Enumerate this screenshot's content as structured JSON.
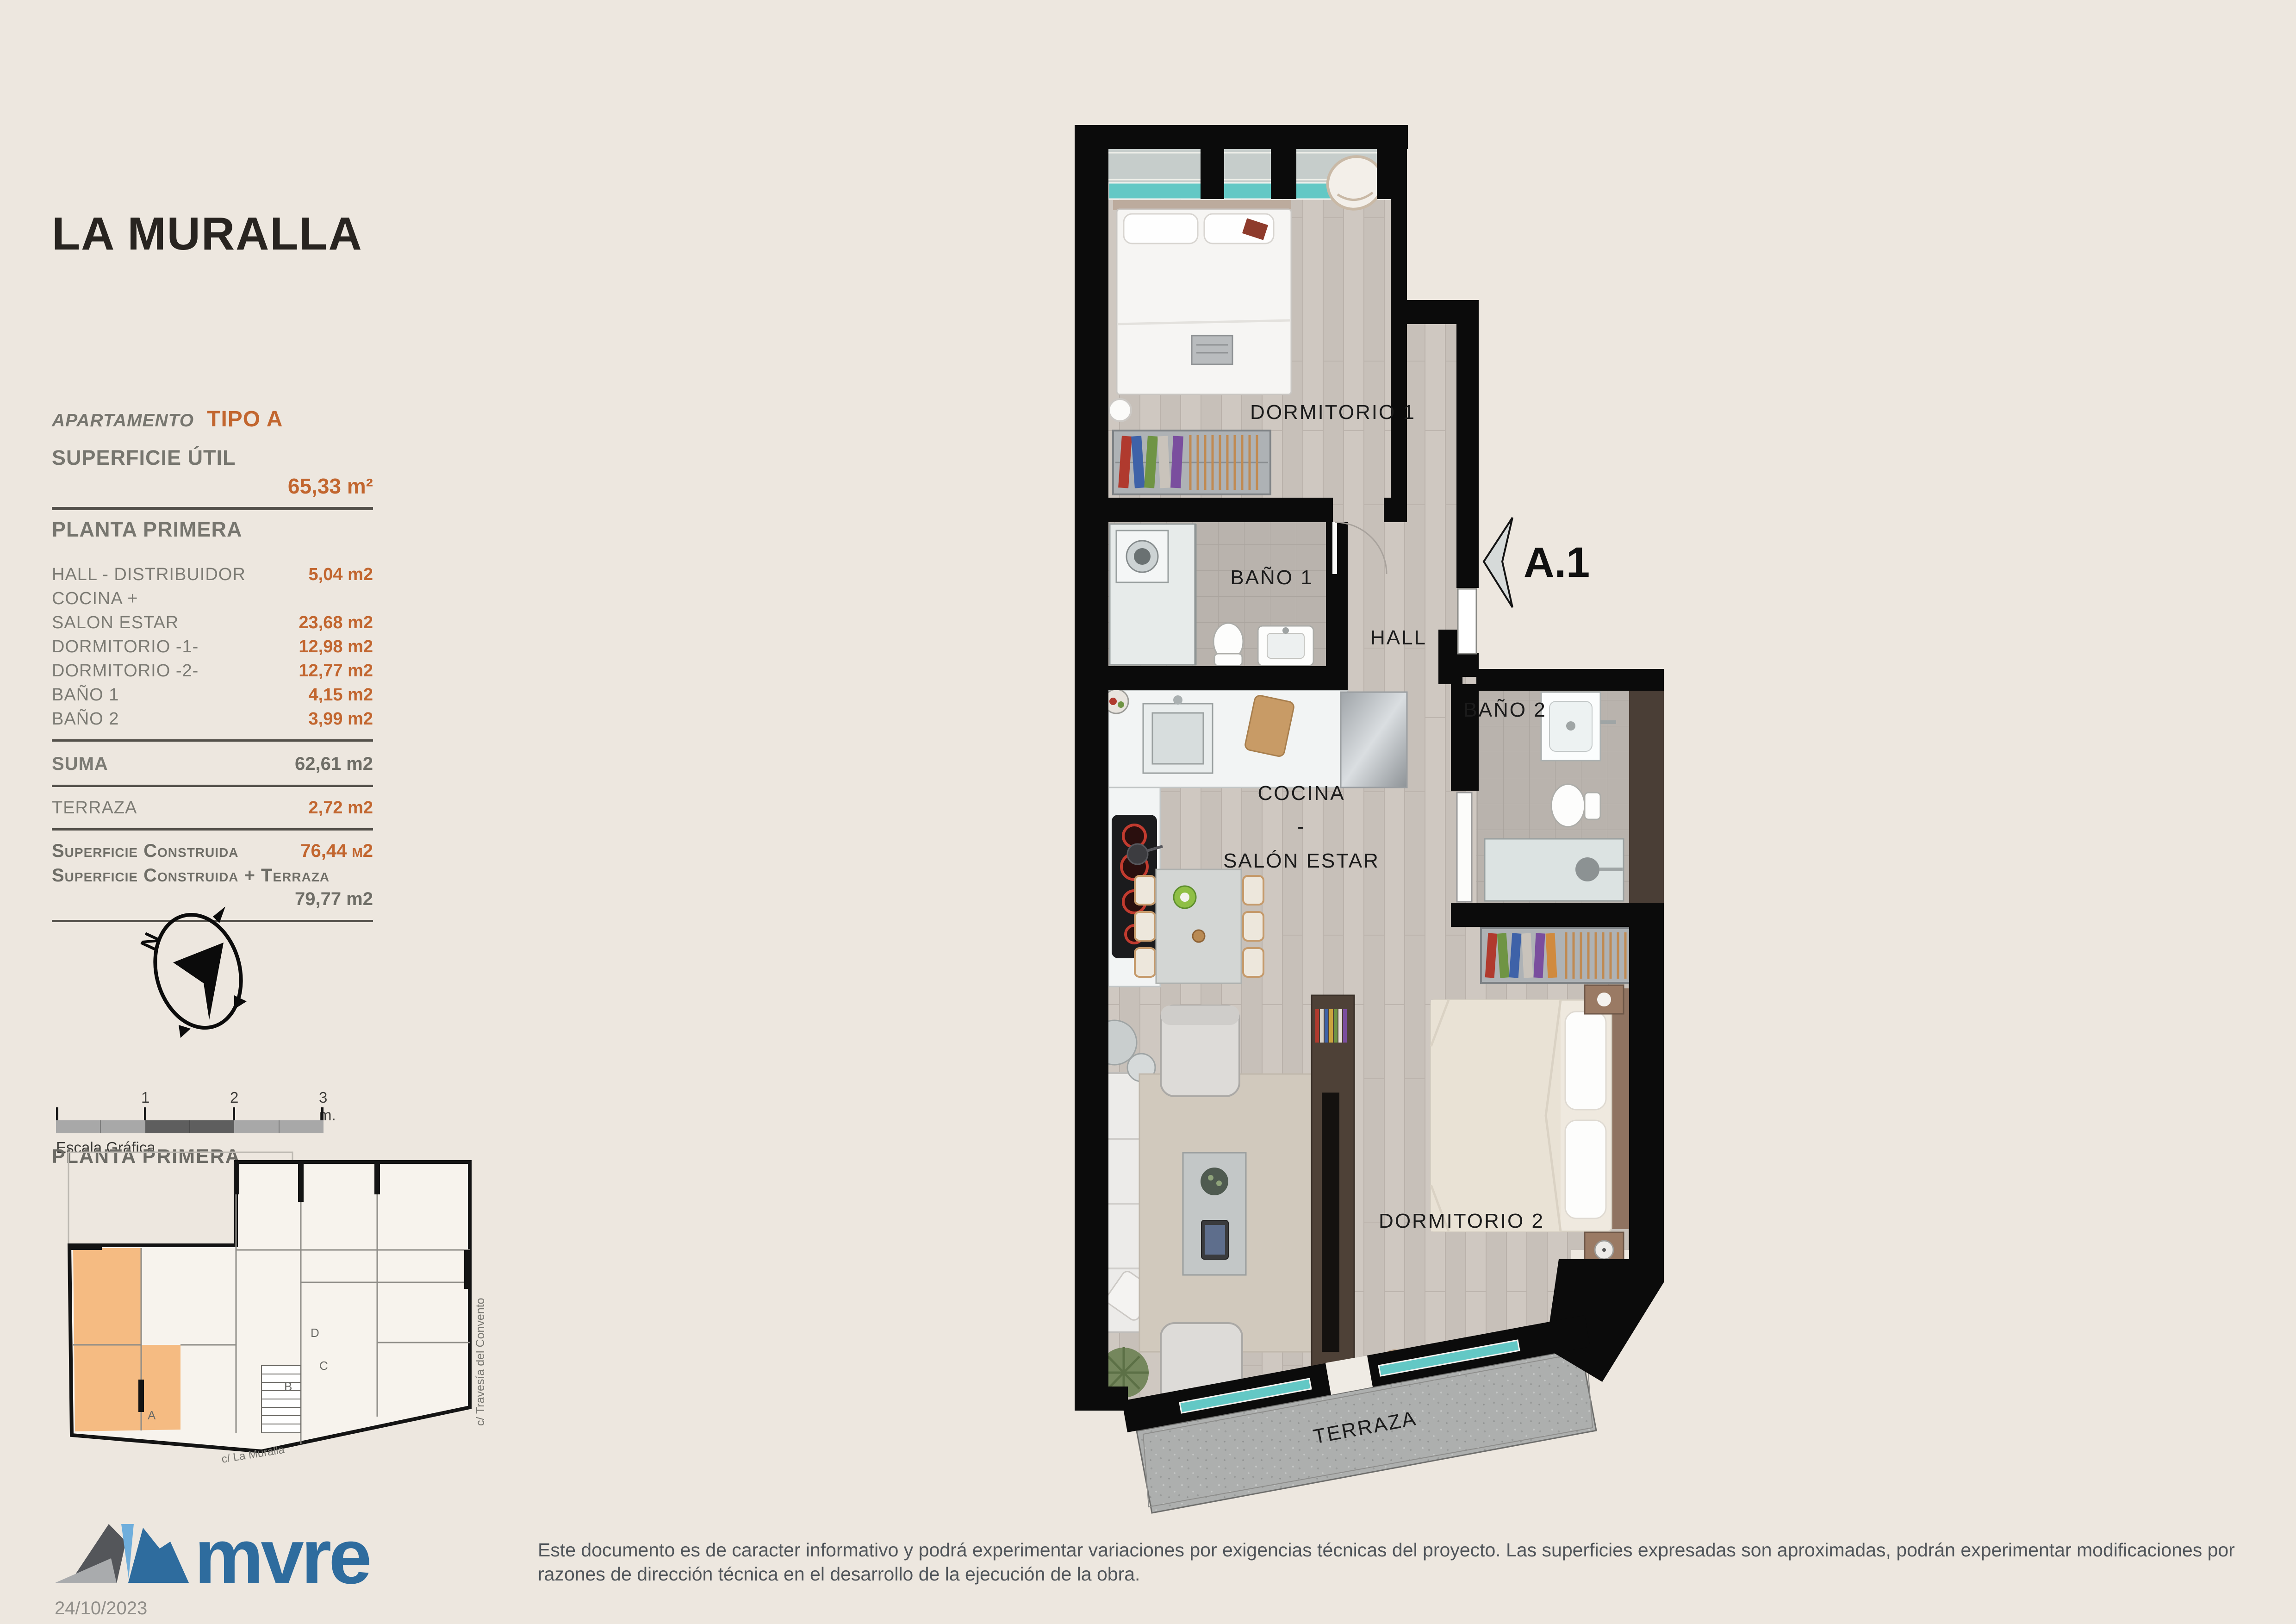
{
  "project": {
    "title": "LA MURALLA",
    "date": "24/10/2023",
    "logo_text": "mvre"
  },
  "info_panel": {
    "apartment_label": "APARTAMENTO",
    "apartment_type": "TIPO A",
    "superficie_util_label": "SUPERFICIE ÚTIL",
    "superficie_util_value": "65,33 m²",
    "floor_label": "PLANTA PRIMERA",
    "rows": [
      {
        "label": "HALL - DISTRIBUIDOR",
        "value": "5,04 m2"
      },
      {
        "label": "COCINA +",
        "value": ""
      },
      {
        "label": "SALON ESTAR",
        "value": "23,68 m2"
      },
      {
        "label": "DORMITORIO -1-",
        "value": "12,98 m2"
      },
      {
        "label": "DORMITORIO -2-",
        "value": "12,77 m2"
      },
      {
        "label": "BAÑO 1",
        "value": "4,15 m2"
      },
      {
        "label": "BAÑO 2",
        "value": "3,99 m2"
      }
    ],
    "suma_label": "SUMA",
    "suma_value": "62,61 m2",
    "terraza_label": "TERRAZA",
    "terraza_value": "2,72 m2",
    "constructed_label": "Superficie Construida",
    "constructed_value": "76,44 m2",
    "constructed_terrace_label": "Superficie Construida + Terraza",
    "constructed_terrace_value": "79,77 m2"
  },
  "compass": {
    "north_label": "N"
  },
  "scale_bar": {
    "ticks": [
      "1",
      "2",
      "3 m."
    ],
    "caption": "Escala Gráfica"
  },
  "site_plan": {
    "title": "PLANTA PRIMERA",
    "street_right": "c/ Travesía del Convento",
    "street_bottom": "c/ La Muralla",
    "unit_labels": [
      "A",
      "B",
      "C",
      "D"
    ]
  },
  "floor_plan": {
    "rooms": {
      "dormitorio1": "DORMITORIO 1",
      "bano1": "BAÑO 1",
      "hall": "HALL",
      "bano2": "BAÑO 2",
      "dormitorio2": "DORMITORIO 2",
      "terraza": "TERRAZA"
    },
    "cocina_lines": [
      "COCINA",
      "-",
      "SALÓN ESTAR"
    ],
    "entry_label": "A.1"
  },
  "footer": {
    "disclaimer_line1": "Este documento es de caracter informativo y podrá experimentar variaciones por exigencias técnicas del proyecto. Las superficies expresadas son aproximadas, podrán experimentar modificaciones por",
    "disclaimer_line2": "razones de dirección técnica en el desarrollo de la ejecución de la obra."
  },
  "colors": {
    "accent_orange": "#C2662F",
    "logo_blue": "#2E6C9E",
    "window_teal": "#63C8C5",
    "unit_highlight": "#F5BB82",
    "wall_black": "#0B0B0B"
  }
}
